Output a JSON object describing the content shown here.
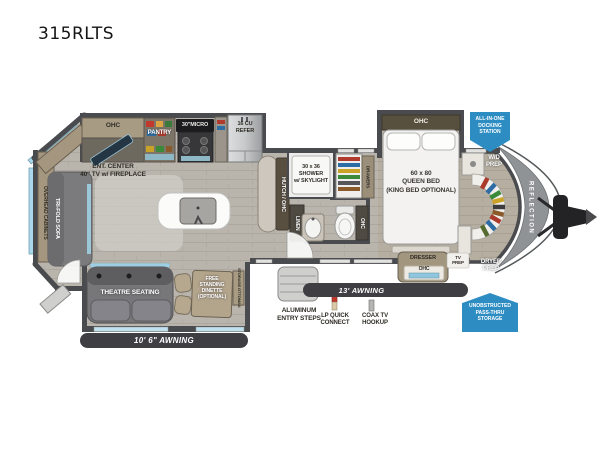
{
  "page": {
    "model": "315RLTS"
  },
  "colors": {
    "badge_blue": "#2d8dc3",
    "awning_dark": "#3f3f43",
    "wall_gray": "#4a4b4e",
    "floor_wood": "#b9b5ad",
    "window_blue": "#a9d8ea",
    "cabinet_tan": "#a5977f",
    "nose_gray": "#8f9396"
  },
  "floorplan": {
    "kitchen": {
      "ohc": "OHC",
      "ent_center": "ENT. CENTER\n40\" TV w/ FIREPLACE",
      "pantry": "PANTRY",
      "micro": "30\"MICRO",
      "refer": "16 CU\nREFER"
    },
    "bath": {
      "hutch": "HUTCH / OHC",
      "shower": "30 x 36\nSHOWER\nw/ SKYLIGHT",
      "linen": "LINEN",
      "toilet_ohc": "OHC"
    },
    "bedroom": {
      "drawers": "DRAWERS",
      "ohc": "OHC",
      "bed": "60 x 80\nQUEEN BED\n(KING BED OPTIONAL)",
      "dresser": "DRESSER",
      "dresser_ohc": "OHC",
      "tv_prep": "TV\nPREP"
    },
    "front": {
      "wd_prep": "W/D\nPREP",
      "dryer_prep": "DRYER\nPREP",
      "brand": "REFLECTION"
    },
    "living": {
      "overhead_cabinets": "OVERHEAD CABINETS",
      "sofa": "TRI-FOLD SOFA",
      "theatre": "THEATRE SEATING",
      "dinette": "FREE\nSTANDING\nDINETTE\n(OPTIONAL)",
      "storage_ottoman": "STORAGE OTTOMAN"
    },
    "exterior": {
      "awning_left": "10' 6\" AWNING",
      "awning_right": "13' AWNING",
      "steps": "ALUMINUM\nENTRY STEPS",
      "lp": "LP QUICK\nCONNECT",
      "coax": "COAX TV\nHOOKUP"
    },
    "badges": {
      "docking": "ALL-IN-ONE\nDOCKING\nSTATION",
      "passthru": "UNOBSTRUCTED\nPASS-THRU\nSTORAGE"
    }
  }
}
